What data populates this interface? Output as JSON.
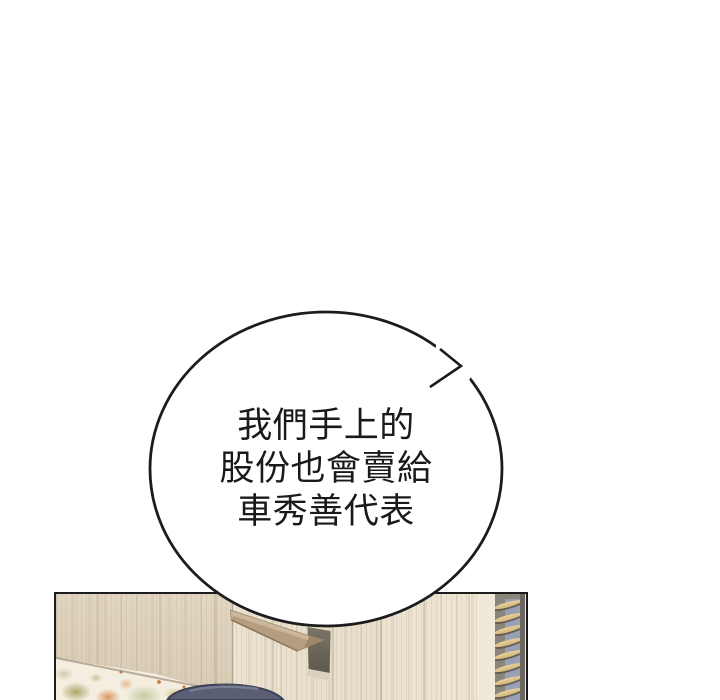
{
  "speech_bubble": {
    "lines": [
      "我們手上的",
      "股份也會賣給",
      "車秀善代表"
    ],
    "fill": "#ffffff",
    "stroke": "#1c1c1c",
    "text_color": "#1a1a1a"
  },
  "panel": {
    "colors": {
      "border": "#1c1c1c",
      "wood_base": "#eae1d0",
      "wood_seam": "#968064",
      "left_wall_shade": "#e3d9c5",
      "shelf_top": "#cbb79a",
      "shelf_side": "#b59d80",
      "shelf_edge": "#8a7258",
      "niche_dark": "#665f53",
      "niche_base": "#d8d1c0",
      "corner_strip": "#f0e9d8",
      "blinds_background": "#8a857b",
      "blinds_blue": "#99a0b6",
      "blinds_slat": "#e2c78e",
      "blinds_edge": "#6b665e",
      "floral_background": "#f3eee0",
      "floral_orange": "#d78d52",
      "floral_olive": "#9f9b52",
      "floral_sage": "#c2c49a",
      "floral_yellow": "#d9cb8a",
      "hair_fill": "#5a5f75",
      "hair_outline": "#3d4156",
      "hair_highlight": "#7d8298"
    }
  }
}
